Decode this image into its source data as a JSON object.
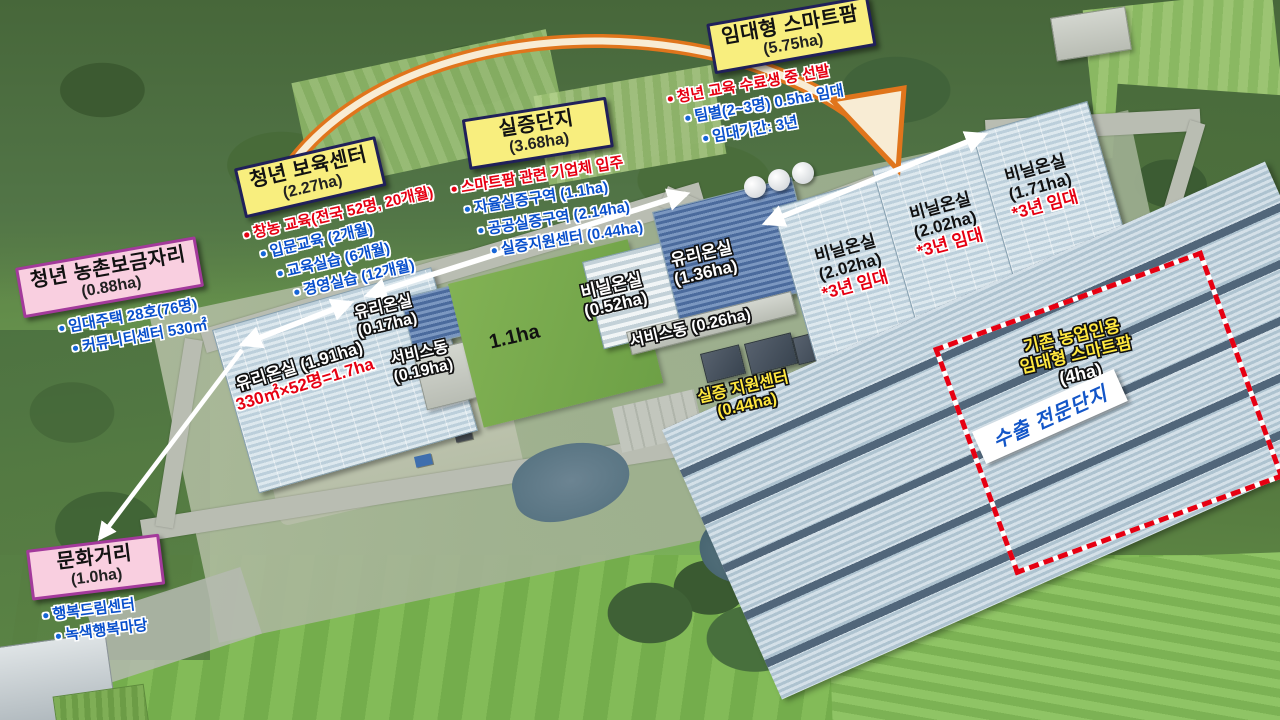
{
  "callouts": {
    "rental_smartfarm": {
      "title": "임대형 스마트팜",
      "area": "(5.75ha)",
      "bullets": [
        {
          "text": "청년 교육 수료생 중 선발"
        },
        {
          "text": "팀별(2~3명) 0.5ha 임대"
        },
        {
          "text": "임대기간: 3년"
        }
      ]
    },
    "demo_complex": {
      "title": "실증단지",
      "area": "(3.68ha)",
      "bullets": [
        {
          "text": "스마트팜 관련 기업체 입주"
        },
        {
          "text": "자율실증구역 (1.1ha)"
        },
        {
          "text": "공공실증구역 (2.14ha)"
        },
        {
          "text": "실증지원센터 (0.44ha)"
        }
      ]
    },
    "youth_center": {
      "title": "청년 보육센터",
      "area": "(2.27ha)",
      "bullets": [
        {
          "text": "창농 교육(전국 52명, 20개월)"
        },
        {
          "text": "입문교육 (2개월)"
        },
        {
          "text": "교육실습 (6개월)"
        },
        {
          "text": "경영실습 (12개월)"
        }
      ]
    },
    "rural_housing": {
      "title": "청년 농촌보금자리",
      "area": "(0.88ha)",
      "bullets": [
        {
          "text": "임대주택 28호(76명)"
        },
        {
          "text": "커뮤니티센터 530㎡"
        }
      ]
    },
    "culture_street": {
      "title": "문화거리",
      "area": "(1.0ha)",
      "bullets": [
        {
          "text": "행복드림센터"
        },
        {
          "text": "녹색행복마당"
        }
      ]
    }
  },
  "map_labels": {
    "glass_191": {
      "name_area": "유리온실 (1.91ha)",
      "note": "330㎡×52명=1.7ha"
    },
    "glass_017": {
      "name": "유리온실",
      "area": "(0.17ha)"
    },
    "service_019": {
      "name": "서비스동",
      "area": "(0.19ha)"
    },
    "grass": {
      "text": "1.1ha"
    },
    "vinyl_052": {
      "name": "비닐온실",
      "area": "(0.52ha)"
    },
    "glass_136": {
      "name": "유리온실",
      "area": "(1.36ha)"
    },
    "service_026": {
      "name_area": "서비스동 (0.26ha)"
    },
    "support_center": {
      "line1": "실증 지원센터",
      "line2": "(0.44ha)"
    },
    "vinyl_a": {
      "name": "비닐온실",
      "area": "(2.02ha)",
      "lease": "*3년 임대"
    },
    "vinyl_b": {
      "name": "비닐온실",
      "area": "(2.02ha)",
      "lease": "*3년 임대"
    },
    "vinyl_c": {
      "name": "비닐온실",
      "area": "(1.71ha)",
      "lease": "*3년 임대"
    },
    "existing_farm": {
      "line1": "기존 농업인용",
      "line2": "임대형 스마트팜",
      "area": "(4ha)"
    },
    "export_zone": {
      "text": "수출 전문단지"
    }
  },
  "colors": {
    "callout_yellow": "#f8ee7e",
    "callout_border": "#20205a",
    "callout_pink": "#f9cfe0",
    "pink_border": "#a33a9b",
    "red_text": "#e60012",
    "blue_text": "#0a50cc",
    "label_yellow": "#ffe83e",
    "orange_arrow": "#e0751c",
    "export_blue": "#1356c8"
  }
}
